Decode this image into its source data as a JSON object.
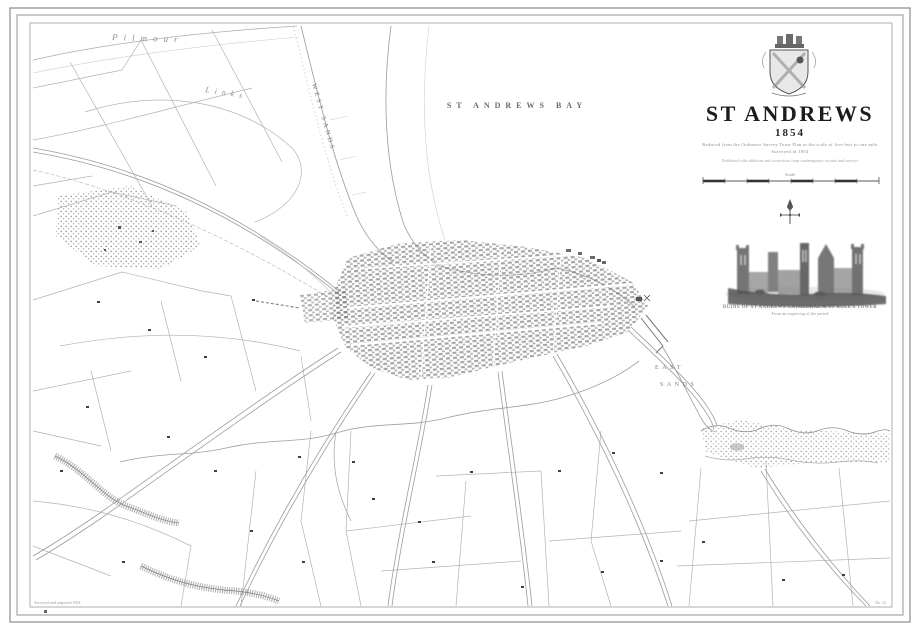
{
  "title_block": {
    "title": "ST ANDREWS",
    "year": "1854",
    "subtitle1": "Reduced from the Ordnance Survey Town Plan at the scale of five feet to one mile",
    "subtitle2": "Surveyed in 1854",
    "fineprint": "Published with additions and corrections from contemporary records and surveys",
    "scale_label": "Scale",
    "vignette_caption1": "RUINS OF ST ANDREWS CATHEDRAL & ST RULE'S TOWER",
    "vignette_caption2": "From an engraving of the period"
  },
  "map_labels": {
    "bay": "ST ANDREWS BAY",
    "west_sands": "WEST SANDS",
    "east": "EAST",
    "sands": "SANDS",
    "pilmour": "Pilmour",
    "links": "Links"
  },
  "imprints": {
    "left": "Surveyed and engraved 1854",
    "right": "No. 12"
  },
  "colors": {
    "ink": "#1c1c1c",
    "line": "#a8a8a8",
    "light_line": "#c8c8c8",
    "label": "#777777",
    "town": "#6f6f6f",
    "paper": "#ffffff"
  }
}
